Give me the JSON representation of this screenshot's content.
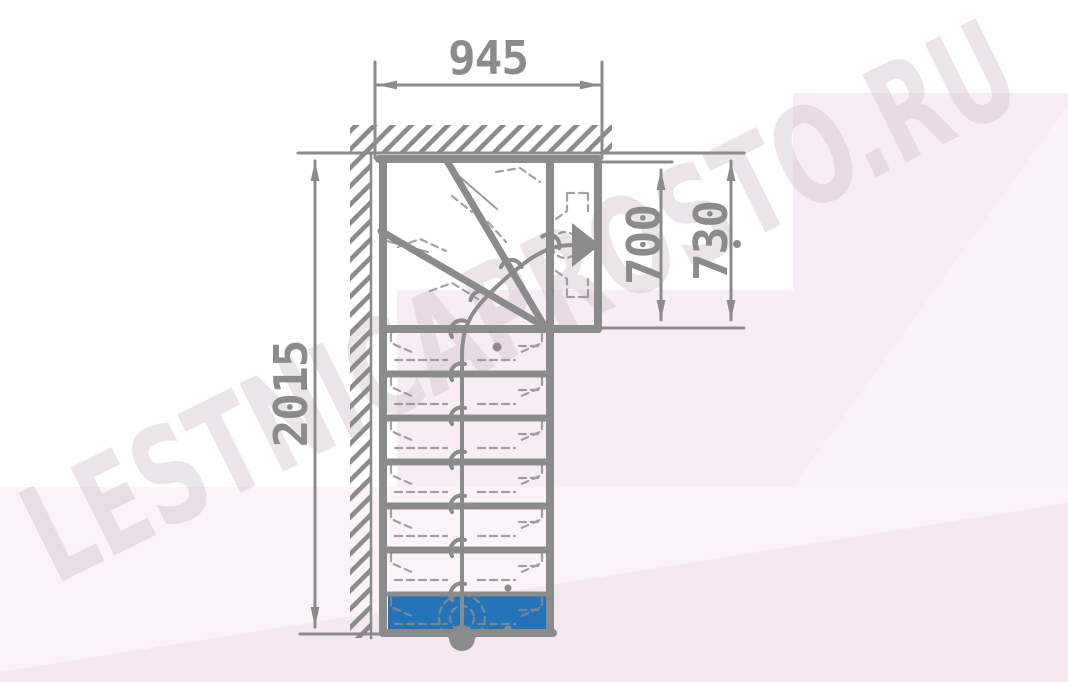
{
  "drawing": {
    "type": "staircase floor plan, top view, quarter turn with winder steps",
    "dimension_labels": {
      "top_width": "945",
      "left_total": "2015",
      "exit_width_inner": "700",
      "exit_width_outer": "730"
    },
    "watermark_text": "LESTNICAPROSTO.RU",
    "colors": {
      "line_gray": "#8b8b8b",
      "first_step_blue": "#2373b9",
      "bg_pink": "#f9edf5",
      "bg_pink_light": "#fcf3f9",
      "bg_pink_dark": "#f6e8f1",
      "watermark": "#cbbcc7"
    }
  }
}
